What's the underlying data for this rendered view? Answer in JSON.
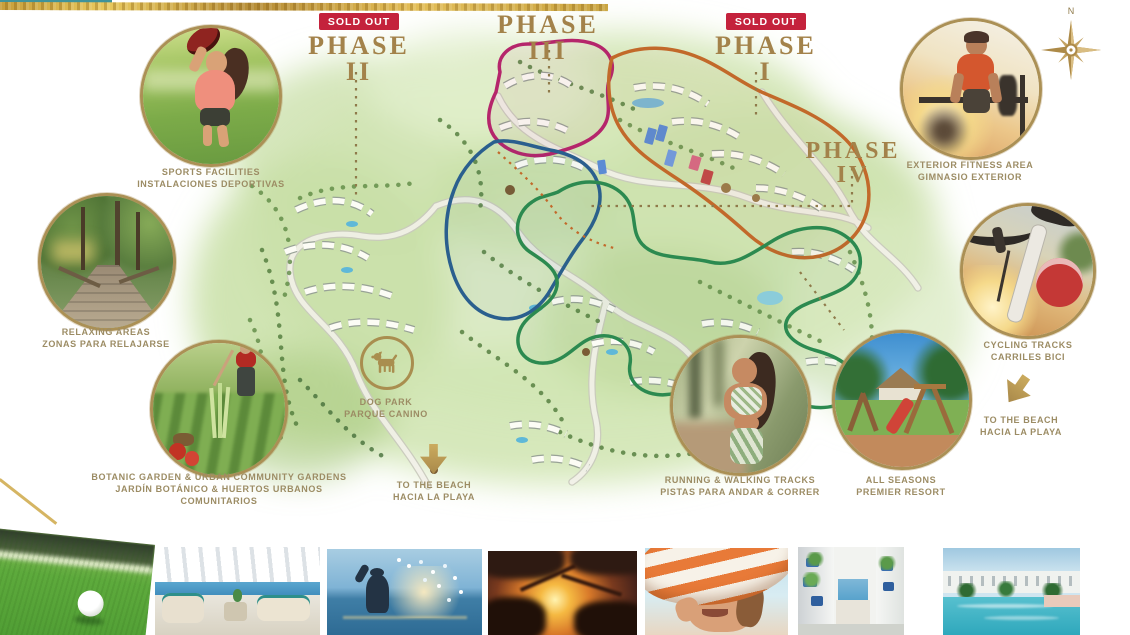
{
  "sold_out_label": "SOLD OUT",
  "compass_north": "N",
  "phases": [
    {
      "label": "PHASE II",
      "sold_out": true,
      "outline_color": "#2a5f8e"
    },
    {
      "label": "PHASE III",
      "sold_out": false,
      "outline_color": "#b5256b"
    },
    {
      "label": "PHASE I",
      "sold_out": true,
      "outline_color": "#c2692a"
    },
    {
      "label": "PHASE IV",
      "sold_out": false,
      "outline_color": "#2c8a50"
    }
  ],
  "amenities": [
    {
      "id": "sports-facilities",
      "lines": [
        "SPORTS FACILITIES",
        "INSTALACIONES DEPORTIVAS"
      ]
    },
    {
      "id": "relaxing-areas",
      "lines": [
        "RELAXING AREAS",
        "ZONAS PARA RELAJARSE"
      ]
    },
    {
      "id": "botanic-garden",
      "lines": [
        "BOTANIC GARDEN & URBAN COMMUNITY GARDENS",
        "JARDÍN BOTÁNICO & HUERTOS URBANOS",
        "COMUNITARIOS"
      ]
    },
    {
      "id": "dog-park",
      "lines": [
        "DOG PARK",
        "PARQUE CANINO"
      ]
    },
    {
      "id": "to-the-beach-left",
      "lines": [
        "TO THE BEACH",
        "HACIA LA PLAYA"
      ]
    },
    {
      "id": "running-walking-tracks",
      "lines": [
        "RUNNING & WALKING TRACKS",
        "PISTAS PARA ANDAR & CORRER"
      ]
    },
    {
      "id": "all-seasons-resort",
      "lines": [
        "ALL SEASONS",
        "PREMIER RESORT"
      ]
    },
    {
      "id": "exterior-fitness-area",
      "lines": [
        "EXTERIOR FITNESS AREA",
        "GIMNASIO EXTERIOR"
      ]
    },
    {
      "id": "cycling-tracks",
      "lines": [
        "CYCLING TRACKS",
        "CARRILES BICI"
      ]
    },
    {
      "id": "to-the-beach-right",
      "lines": [
        "TO THE BEACH",
        "HACIA LA PLAYA"
      ]
    }
  ],
  "colors": {
    "gold": "#a98e4f",
    "badge_red": "#c4223c",
    "caption_text": "#9c8c64",
    "map_wash_green": "#d4e6b6"
  },
  "gallery": [
    {
      "name": "golf-ball-on-green"
    },
    {
      "name": "sea-view-terrace"
    },
    {
      "name": "sea-splash-at-sunset"
    },
    {
      "name": "sunset-through-palms"
    },
    {
      "name": "woman-striped-sun-hat"
    },
    {
      "name": "mediterranean-alley-sea-view"
    },
    {
      "name": "resort-pool-apartments"
    }
  ]
}
